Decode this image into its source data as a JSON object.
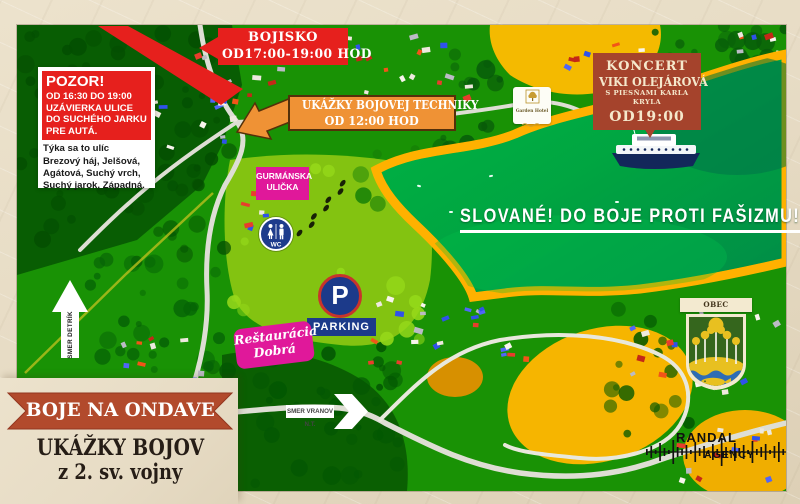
{
  "poster": {
    "banner_title": "BOJE NA ONDAVE",
    "subtitle_line1": "UKÁŽKY BOJOV",
    "subtitle_line2": "z 2. sv. vojny"
  },
  "callouts": {
    "bojisko": {
      "title": "BOJISKO",
      "time": "OD17:00-19:00 HOD"
    },
    "technika": {
      "title": "UKÁŽKY BOJOVEJ TECHNIKY",
      "time": "OD 12:00 HOD"
    },
    "koncert": {
      "title": "KONCERT",
      "artist": "VIKI OLEJÁROVÁ",
      "subtitle": "S PIESŇAMI KARLA KRYLA",
      "time": "OD19:00"
    },
    "pozor": {
      "title": "POZOR!",
      "red_lines": [
        "OD 16:30 DO 19:00",
        "UZÁVIERKA ULICE",
        "DO SUCHÉHO JARKU",
        "PRE AUTÁ."
      ],
      "note_lines": [
        "Týka sa to ulíc",
        "Brezový háj, Jelšová,",
        "Agátová, Suchý vrch,",
        "Suchý jarok, Západná."
      ]
    },
    "slogan": "SLOVANÉ! DO BOJE PROTI FAŠIZMU!"
  },
  "map_labels": {
    "gurmanska_line1": "GURMÁNSKA",
    "gurmanska_line2": "ULIČKA",
    "restauracia_line1": "Reštaurácia",
    "restauracia_line2": "Dobrá",
    "parking_letter": "P",
    "parking_label": "PARKING",
    "wc_label": "WC",
    "direction_detrik": "SMER DETRÍK",
    "direction_vranov": "SMER VRANOV N.T.",
    "garden_hotel": "Garden Hotel"
  },
  "badges": {
    "municipality": "OBEC KVAKOVCE",
    "agency_line1": "RANDAL",
    "agency_line2": "AGENCY"
  },
  "colors": {
    "alert_red": "#e6201d",
    "brick_red": "#a5432c",
    "ribbon_red": "#b24a2c",
    "orange": "#ef9235",
    "magenta": "#e0189a",
    "navy_blue": "#1c3a8a",
    "water_green": "#12a351",
    "shore_yellow": "#f1af1a",
    "paper_beige": "#e7dcc5"
  }
}
